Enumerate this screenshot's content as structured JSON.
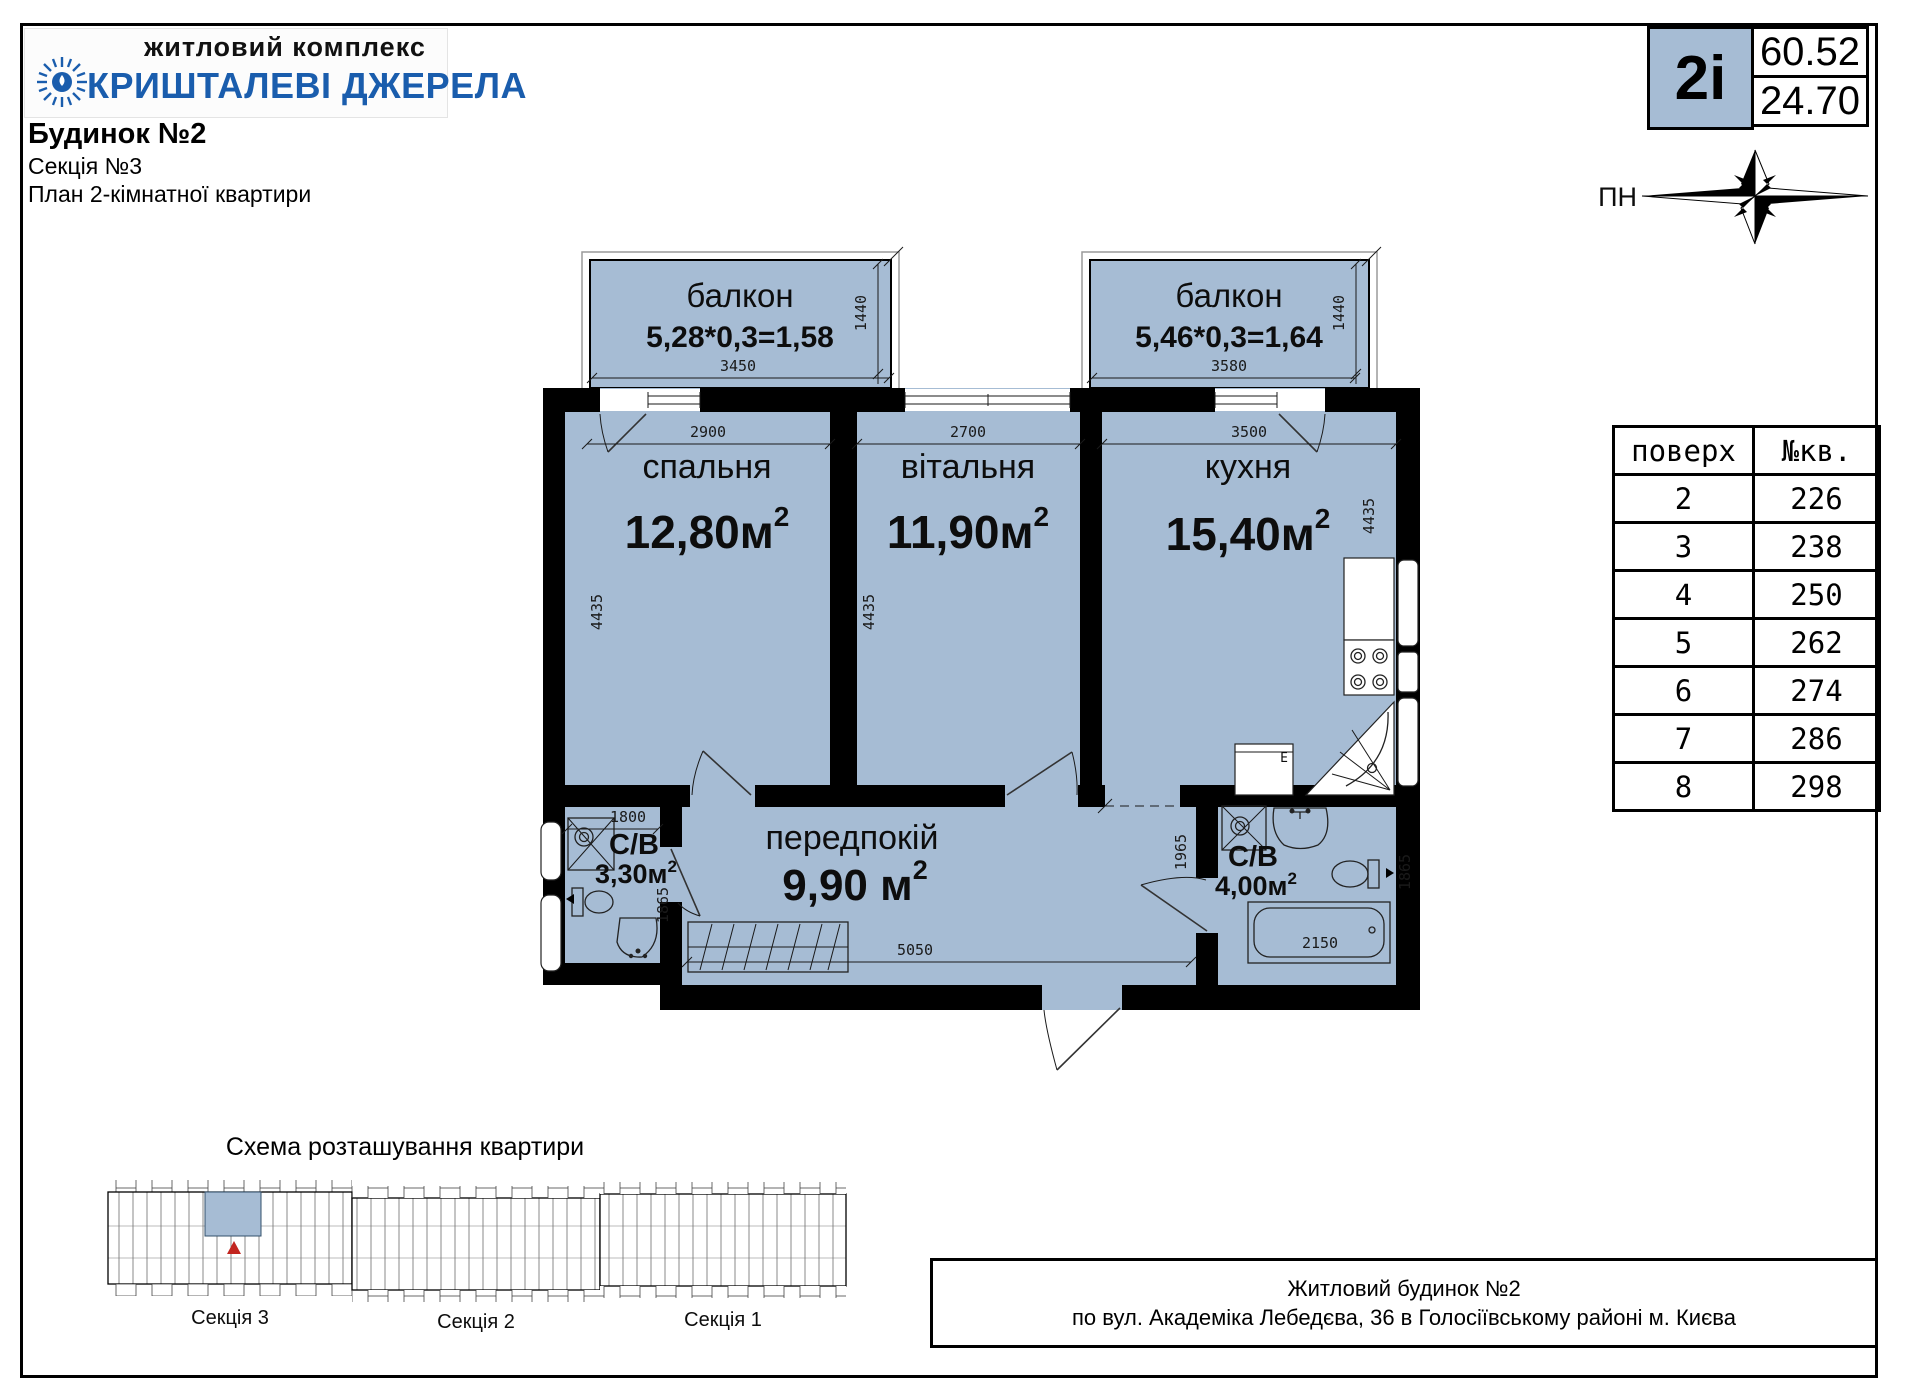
{
  "logo": {
    "top": "житловий комплекс",
    "name": "КРИШТАЛЕВІ ДЖЕРЕЛА"
  },
  "header": {
    "building": "Будинок №2",
    "section": "Секція №3",
    "plan_title": "План 2-кімнатної квартири"
  },
  "badge": {
    "apt_type": "2i",
    "total_area": "60.52",
    "living_area": "24.70"
  },
  "compass": {
    "north": "ПН"
  },
  "floors_table": {
    "col_floor": "поверх",
    "col_apt": "№кв.",
    "rows": [
      {
        "floor": "2",
        "apt": "226"
      },
      {
        "floor": "3",
        "apt": "238"
      },
      {
        "floor": "4",
        "apt": "250"
      },
      {
        "floor": "5",
        "apt": "262"
      },
      {
        "floor": "6",
        "apt": "274"
      },
      {
        "floor": "7",
        "apt": "286"
      },
      {
        "floor": "8",
        "apt": "298"
      }
    ]
  },
  "plan": {
    "balcony_left": {
      "label": "балкон",
      "formula": "5,28*0,3=1,58",
      "width_mm": "3450",
      "depth_mm": "1440"
    },
    "balcony_right": {
      "label": "балкон",
      "formula": "5,46*0,3=1,64",
      "width_mm": "3580",
      "depth_mm": "1440"
    },
    "bedroom": {
      "label": "спальня",
      "area": "12,80м",
      "area_sup": "2",
      "width_mm": "2900",
      "height_mm": "4435"
    },
    "living": {
      "label": "вітальня",
      "area": "11,90м",
      "area_sup": "2",
      "width_mm": "2700",
      "height_mm": "4435"
    },
    "kitchen": {
      "label": "кухня",
      "area": "15,40м",
      "area_sup": "2",
      "width_mm": "3500",
      "height_mm": "4435",
      "appliance_label": "E"
    },
    "hall": {
      "label": "передпокій",
      "area": "9,90 м",
      "area_sup": "2",
      "width_mm": "5050",
      "height_mm": "1965"
    },
    "bath1": {
      "label": "С/В",
      "area": "3,30м",
      "area_sup": "2",
      "width_mm": "1800",
      "height_mm": "1865"
    },
    "bath2": {
      "label": "С/В",
      "area": "4,00м",
      "area_sup": "2",
      "tub_mm": "2150",
      "height_mm": "1865"
    }
  },
  "scheme": {
    "title": "Схема розташування квартири",
    "sections": [
      "Секція 3",
      "Секція 2",
      "Секція 1"
    ]
  },
  "footer": {
    "line1": "Житловий будинок №2",
    "line2": "по вул. Академіка Лебедєва, 36 в Голосіївському районі м. Києва"
  },
  "colors": {
    "room_fill": "#a6bcd4",
    "brand_blue": "#1a5dad",
    "wall": "#000000",
    "marker_red": "#c2251f"
  }
}
